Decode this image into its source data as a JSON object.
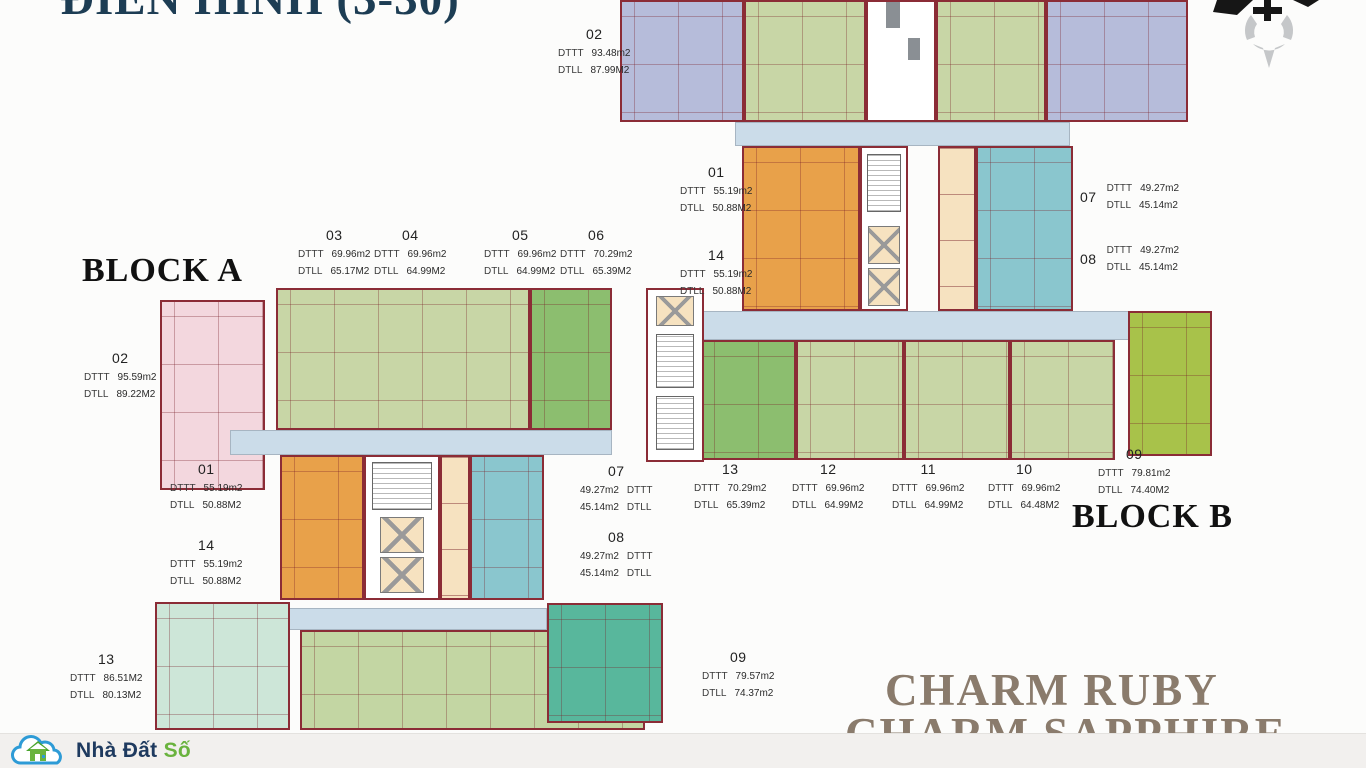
{
  "title": "ĐIỂN HÌNH (3-30)",
  "block_a_label": "BLOCK A",
  "block_b_label": "BLOCK B",
  "watermark": {
    "line1": "CHARM RUBY",
    "line2": "CHARM SAPPHIRE"
  },
  "logo": {
    "name": "Nhà Đất Số",
    "text_primary": "Nhà Đất",
    "text_accent": "Số"
  },
  "field_labels": {
    "dttt": "DTTT",
    "dtll": "DTLL"
  },
  "units": {
    "b_top_02": {
      "no": "02",
      "dttt": "93.48m2",
      "dtll": "87.99M2"
    },
    "a_03": {
      "no": "03",
      "dttt": "69.96m2",
      "dtll": "65.17M2"
    },
    "a_04": {
      "no": "04",
      "dttt": "69.96m2",
      "dtll": "64.99M2"
    },
    "a_05": {
      "no": "05",
      "dttt": "69.96m2",
      "dtll": "64.99M2"
    },
    "a_06": {
      "no": "06",
      "dttt": "70.29m2",
      "dtll": "65.39M2"
    },
    "b_01": {
      "no": "01",
      "dttt": "55.19m2",
      "dtll": "50.88M2"
    },
    "b_14": {
      "no": "14",
      "dttt": "55.19m2",
      "dtll": "50.88M2"
    },
    "b_07": {
      "no": "07",
      "dttt": "49.27m2",
      "dtll": "45.14m2"
    },
    "b_08": {
      "no": "08",
      "dttt": "49.27m2",
      "dtll": "45.14m2"
    },
    "a_02": {
      "no": "02",
      "dttt": "95.59m2",
      "dtll": "89.22M2"
    },
    "a_01": {
      "no": "01",
      "dttt": "55.19m2",
      "dtll": "50.88M2"
    },
    "a_14": {
      "no": "14",
      "dttt": "55.19m2",
      "dtll": "50.88M2"
    },
    "a_07": {
      "no": "07",
      "dttt": "49.27m2",
      "dtll": "45.14m2"
    },
    "a_08": {
      "no": "08",
      "dttt": "49.27m2",
      "dtll": "45.14m2"
    },
    "b_13": {
      "no": "13",
      "dttt": "70.29m2",
      "dtll": "65.39m2"
    },
    "b_12": {
      "no": "12",
      "dttt": "69.96m2",
      "dtll": "64.99M2"
    },
    "b_11": {
      "no": "11",
      "dttt": "69.96m2",
      "dtll": "64.99M2"
    },
    "b_10": {
      "no": "10",
      "dttt": "69.96m2",
      "dtll": "64.48M2"
    },
    "b_09": {
      "no": "09",
      "dttt": "79.81m2",
      "dtll": "74.40M2"
    },
    "a_13": {
      "no": "13",
      "dttt": "86.51M2",
      "dtll": "80.13M2"
    },
    "a_09": {
      "no": "09",
      "dttt": "79.57m2",
      "dtll": "74.37m2"
    }
  },
  "colors": {
    "wall": "#8b2c36",
    "corridor": "#cbdce9",
    "unit_lavender": "#b6bcda",
    "unit_green": "#c8d6a6",
    "unit_green_dark": "#8cbe6f",
    "unit_green_yellow": "#a8c24a",
    "unit_pink": "#f3d7de",
    "unit_orange": "#e8a14a",
    "unit_teal": "#8ac6ce",
    "unit_mint": "#cde6d8",
    "unit_teal_dark": "#58b79c",
    "elevator_beige": "#f6e2c0",
    "title_navy": "#1d3d54",
    "watermark_brown": "#8a7b6c",
    "logo_blue": "#2e9bd6",
    "logo_navy": "#1e3a5f",
    "logo_green": "#6ab33e"
  }
}
